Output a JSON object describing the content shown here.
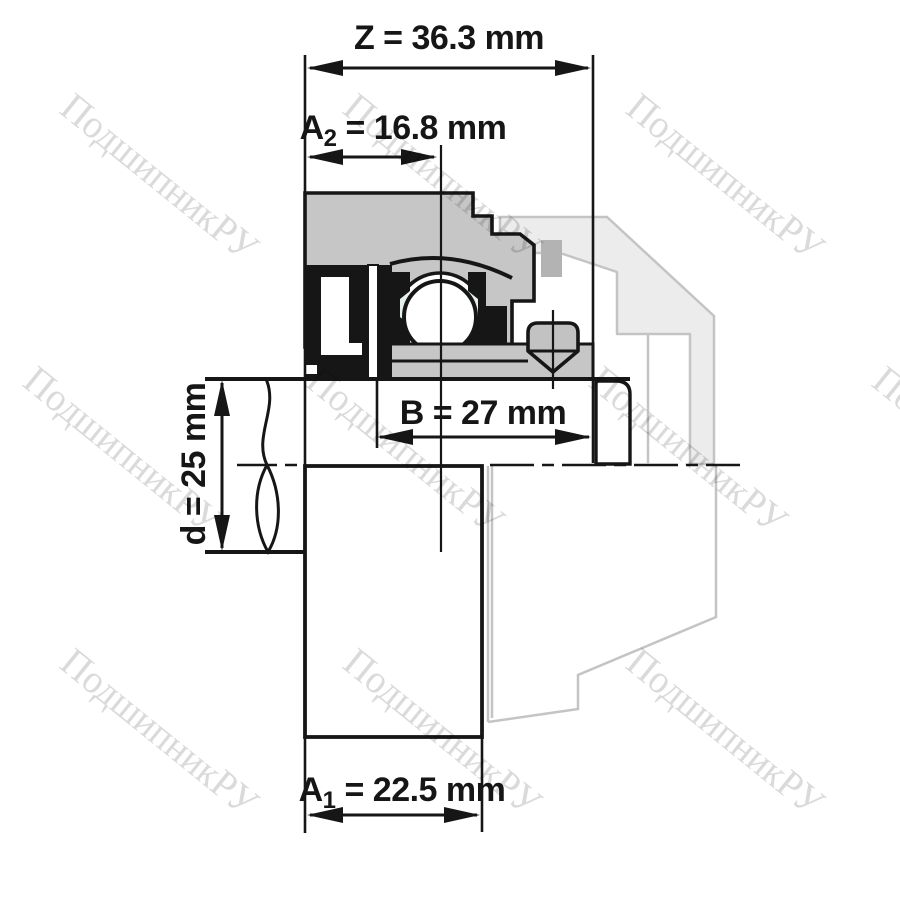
{
  "page": {
    "background": "#ffffff",
    "description": "Technical cross-section drawing of a radial insert ball bearing unit (shaft mounted, ghosted flange housing) with dimension callouts"
  },
  "watermark": {
    "text": "ПодшипникРУ",
    "color": "#dadada"
  },
  "drawing": {
    "type": "bearing-insert-cross-section",
    "colors": {
      "outline": "#161616",
      "housing_fill": "#c6c6c6",
      "cage_fill": "#e7efeb",
      "seal_fill": "#161616",
      "ghost_fill": "#ececec",
      "ghost_line": "#c4c4c4",
      "ghost_dark_fill": "#b3b3b3",
      "ball_fill": "#ffffff"
    }
  },
  "dimensions": {
    "z": {
      "symbol": "Z",
      "value": "36.3",
      "unit": "mm",
      "label": "Z = 36.3 mm"
    },
    "a2": {
      "symbol": "A",
      "subscript": "2",
      "rest": " = 16.8 mm",
      "value": "16.8",
      "unit": "mm"
    },
    "b": {
      "symbol": "B",
      "value": "27",
      "unit": "mm",
      "label": "B = 27 mm"
    },
    "d": {
      "symbol": "d",
      "value": "25",
      "unit": "mm",
      "label": "d = 25 mm"
    },
    "a1": {
      "symbol": "A",
      "subscript": "1",
      "rest": " = 22.5 mm",
      "value": "22.5",
      "unit": "mm"
    }
  }
}
